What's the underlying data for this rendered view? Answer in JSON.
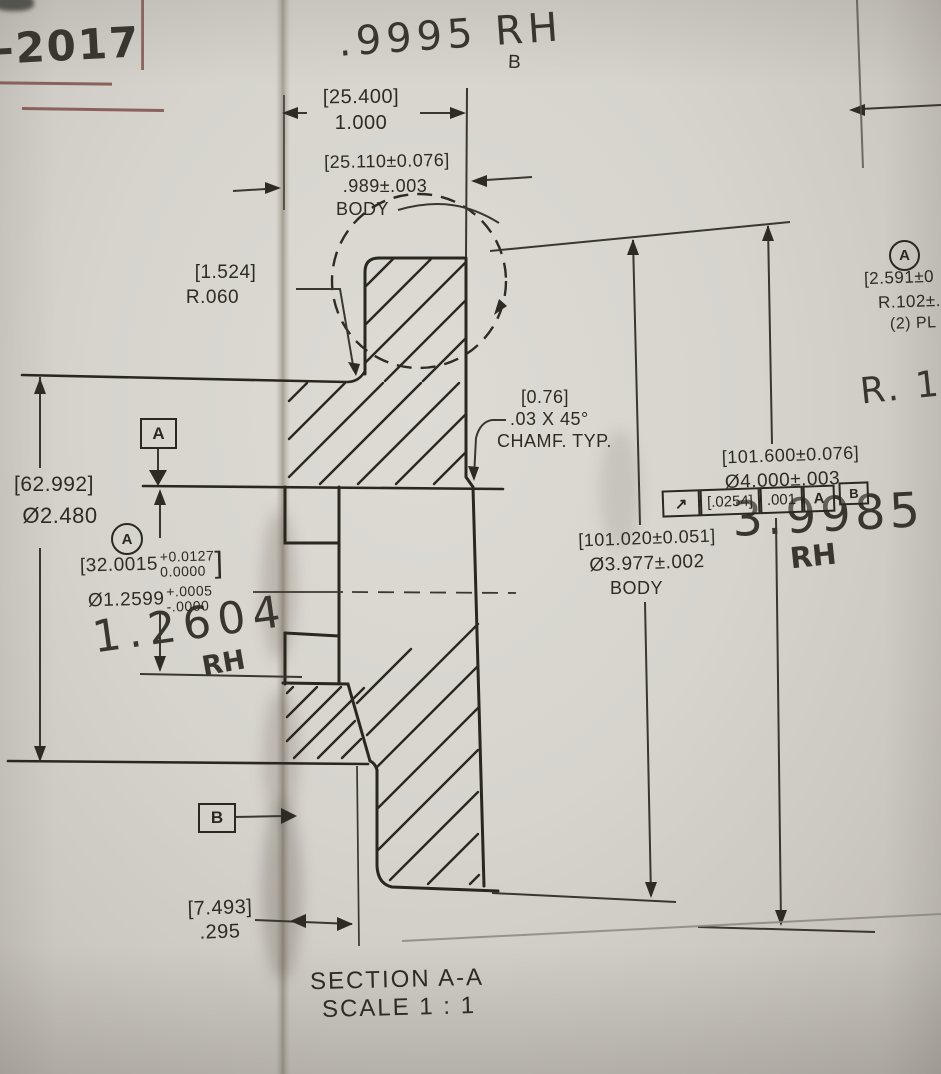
{
  "handwritten": {
    "year_note": "-2017",
    "top_measure": ".9995 RH",
    "bore_measure": "1.2604",
    "bore_rh": "RH",
    "od_measure": "3.9985",
    "od_rh": "RH",
    "radius_note": "R. 1C"
  },
  "dims": {
    "width_mm": "[25.400]",
    "width_in": "1.000",
    "body_width_mm": "[25.110±0.076]",
    "body_width_in": ".989±.003",
    "body_width_label": "BODY",
    "fillet_mm": "[1.524]",
    "fillet_in": "R.060",
    "chamfer_mm": "[0.76]",
    "chamfer_in": ".03  X 45°",
    "chamfer_label": "CHAMF. TYP.",
    "mid_dia_mm": "[62.992]",
    "mid_dia_in": "Ø2.480",
    "bore_mm_open": "[32.0015",
    "bore_mm_plus": "+0.0127",
    "bore_mm_minus": "0.0000",
    "bore_mm_close": "]",
    "bore_in": "Ø1.2599",
    "bore_in_plus": "+.0005",
    "bore_in_minus": "-.0000",
    "od_body_mm": "[101.020±0.051]",
    "od_body_in": "Ø3.977±.002",
    "od_body_label": "BODY",
    "od_mm": "[101.600±0.076]",
    "od_in": "Ø4.000±.003",
    "hub_th_mm": "[7.493]",
    "hub_th_in": ".295",
    "corner_r_mm": "[2.591±0",
    "corner_r_in": "R.102±.",
    "corner_r_places": "(2) PL"
  },
  "fcf": {
    "symbol": "↗",
    "tol_mm": "[.0254]",
    "tol_in": ".001",
    "datum1": "A",
    "datum2": "B"
  },
  "datums": {
    "a": "A",
    "b": "B",
    "circled_left": "A",
    "circled_right": "A"
  },
  "detail": {
    "label": "B"
  },
  "title": {
    "section": "SECTION A-A",
    "scale": "SCALE 1 : 1"
  }
}
